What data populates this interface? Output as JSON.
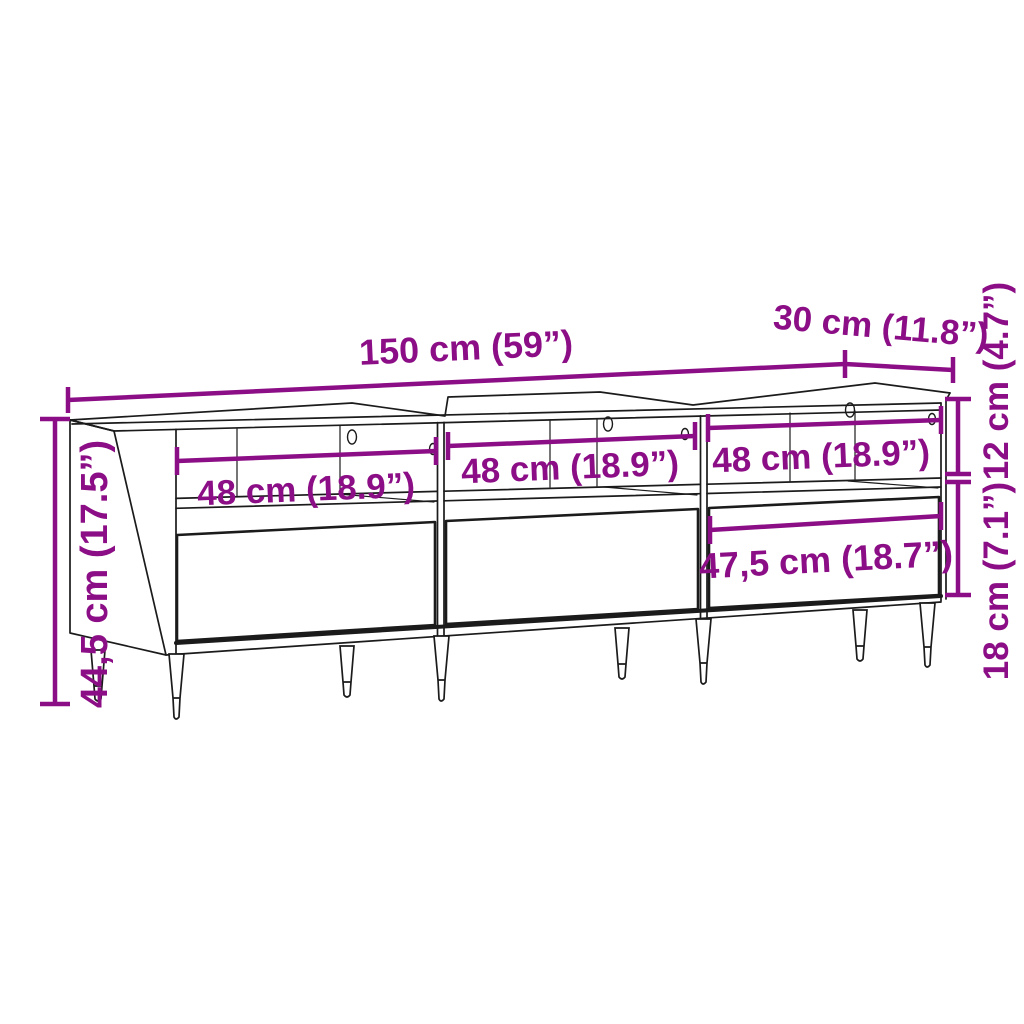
{
  "dimensions": {
    "overall_width": "150 cm (59”)",
    "overall_depth": "30 cm (11.8”)",
    "overall_height": "44,5 cm (17.5”)",
    "compartment_height": "12 cm (4.7”)",
    "drawer_front_height": "18 cm (7.1”)",
    "compartment_width_left": "48 cm (18.9”)",
    "compartment_width_middle": "48 cm (18.9”)",
    "compartment_width_right": "48 cm (18.9”)",
    "drawer_inner_width": "47,5 cm (18.7”)"
  },
  "colors": {
    "dimension_accent": "#8C0E86",
    "line_color": "#1b1b1b",
    "background": "#ffffff"
  }
}
